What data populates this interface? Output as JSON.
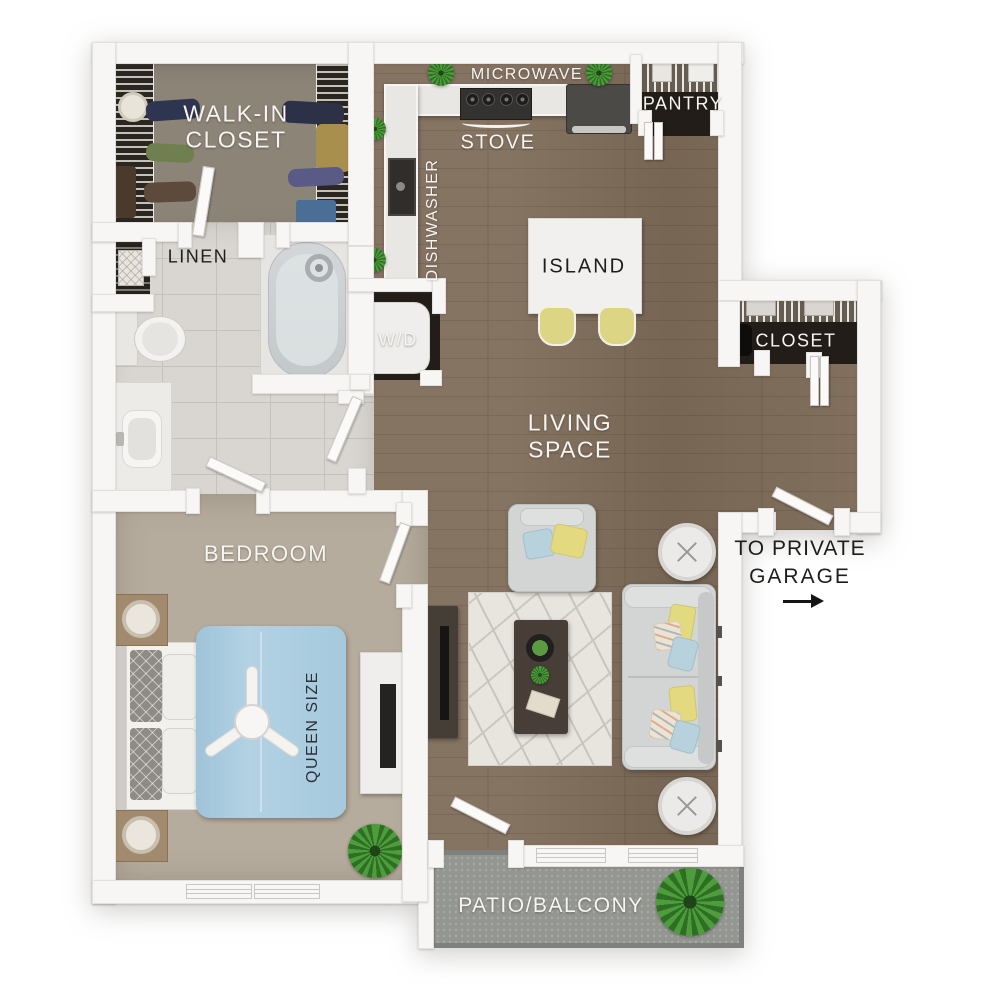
{
  "labels": {
    "walk_in_closet_1": "WALK-IN",
    "walk_in_closet_2": "CLOSET",
    "linen": "LINEN",
    "microwave": "MICROWAVE",
    "stove": "STOVE",
    "pantry": "PANTRY",
    "dishwasher": "DISHWASHER",
    "washer_dryer": "W/D",
    "island": "ISLAND",
    "closet": "CLOSET",
    "living_1": "LIVING",
    "living_2": "SPACE",
    "bedroom": "BEDROOM",
    "queen": "QUEEN SIZE",
    "garage_1": "TO PRIVATE",
    "garage_2": "GARAGE",
    "patio": "PATIO/BALCONY"
  },
  "colors": {
    "wood_floor": "#7e6b59",
    "bedroom_carpet": "#b6ac9d",
    "bathroom_tile": "#d9d6d1",
    "walkin_floor": "#8d8478",
    "patio_concrete": "#949692",
    "wall": "#f7f6f4",
    "closet_interior": "#221d18",
    "bed_duvet": "#abcde0",
    "sofa_gray": "#d3d4d4",
    "accent_yellow": "#e3da7f",
    "accent_blue": "#b7d2dd",
    "plant_green": "#47953a",
    "label_light": "#f7f5f2",
    "label_dark": "#1d1d1b"
  }
}
